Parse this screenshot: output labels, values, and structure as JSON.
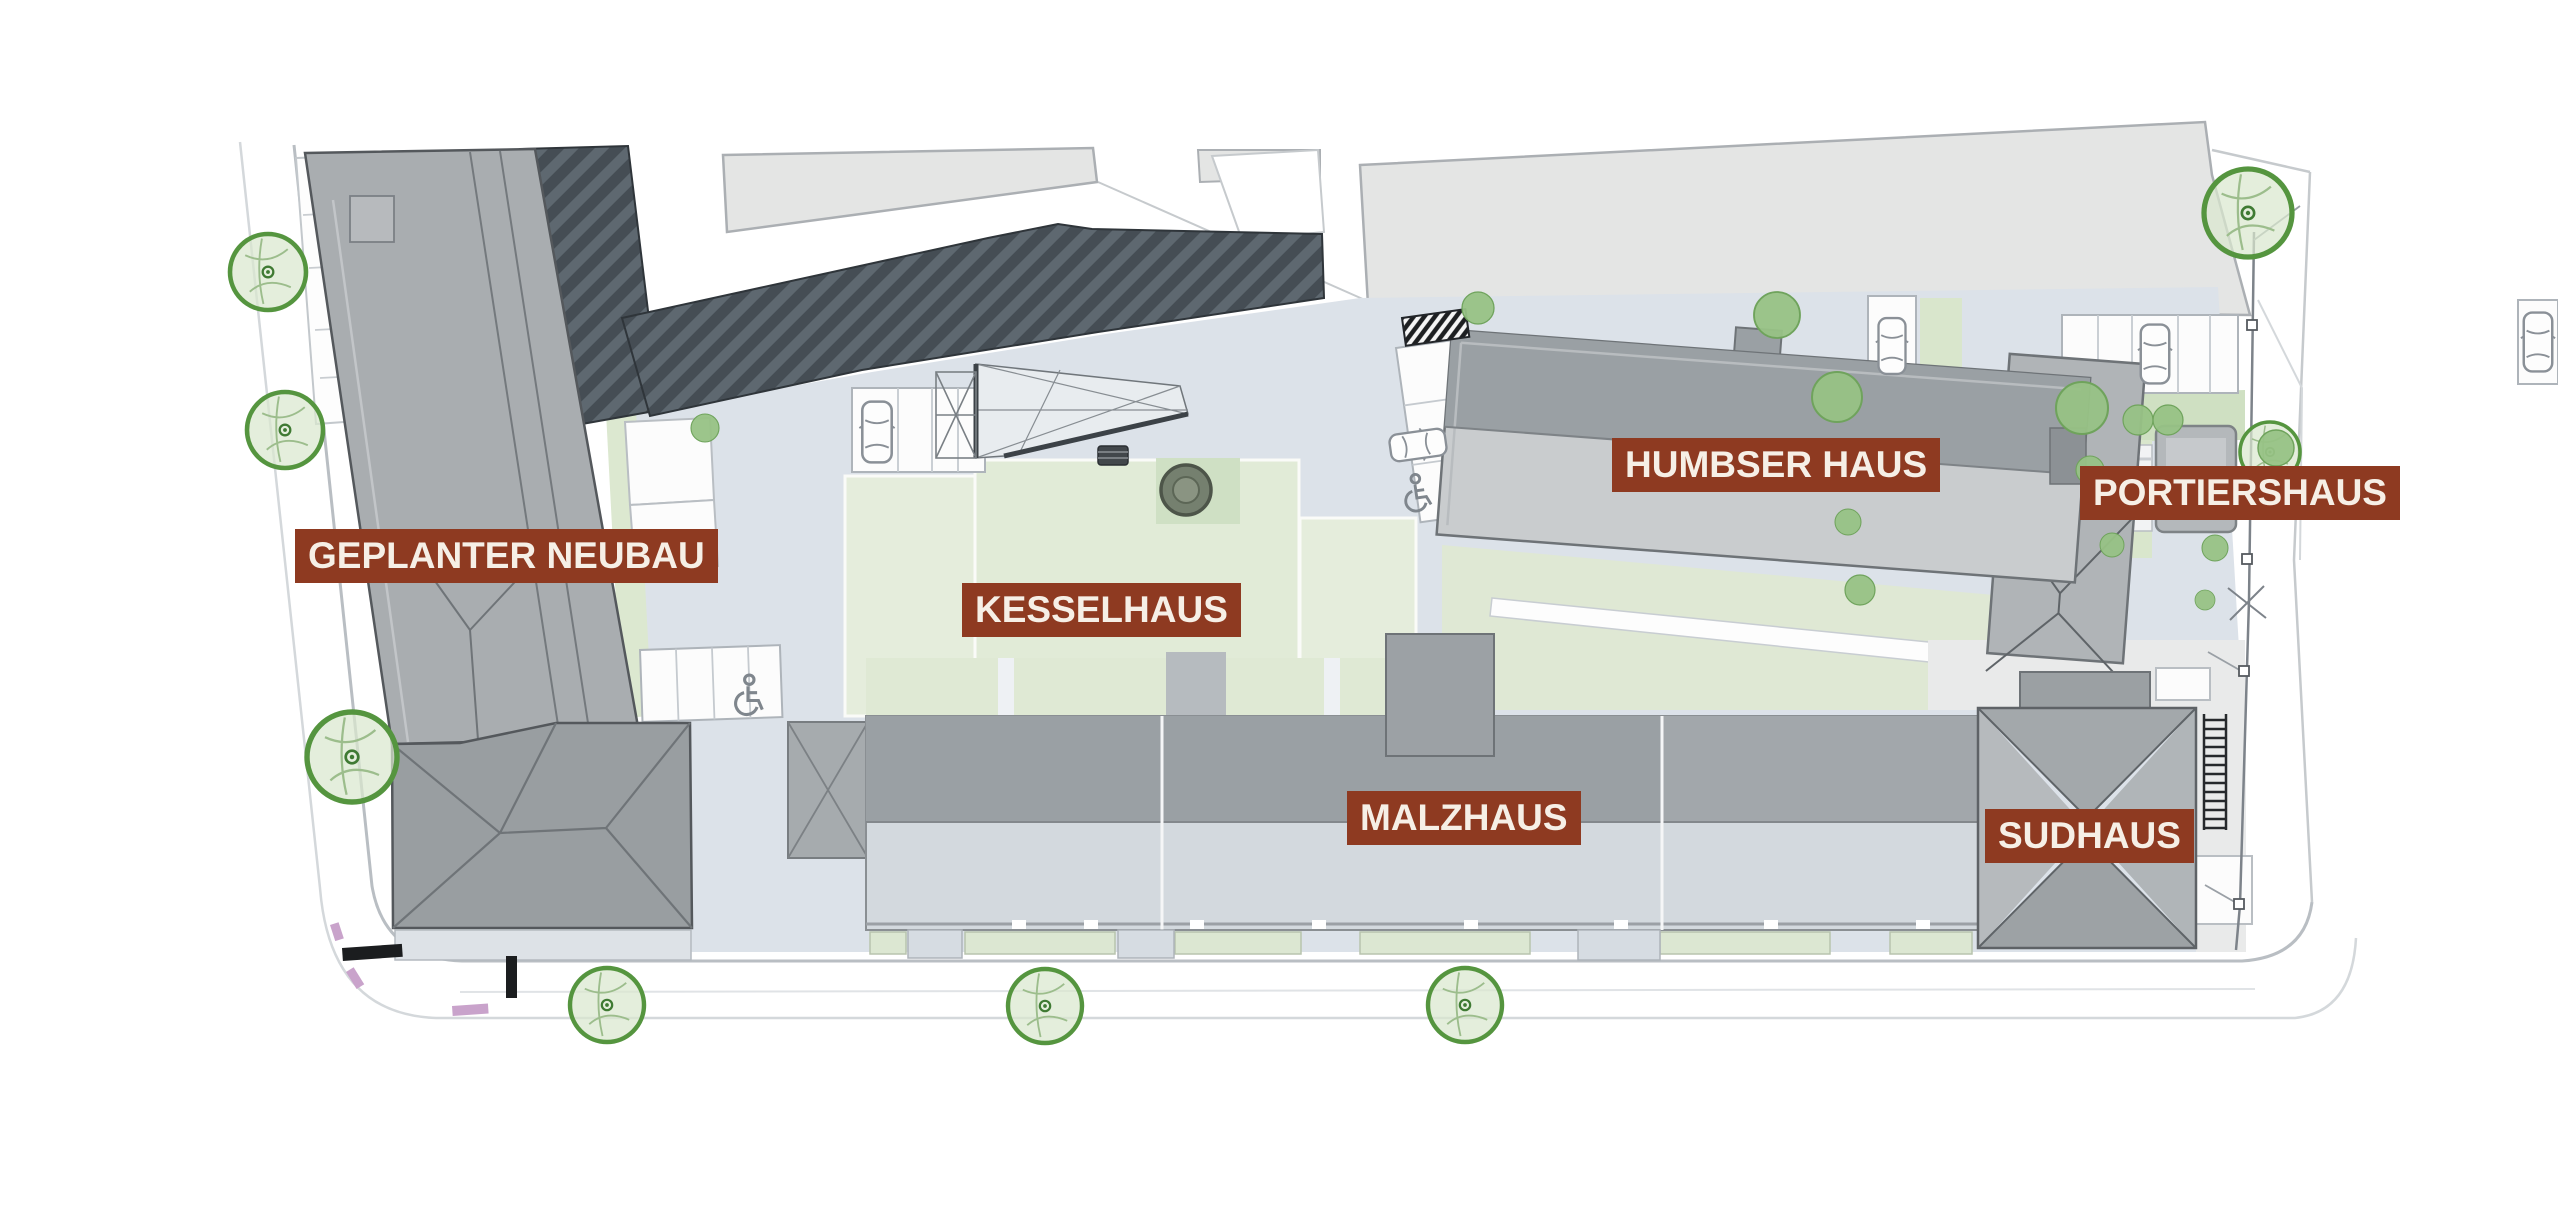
{
  "plan": {
    "type": "architectural-site-plan",
    "building_names": [
      "GEPLANTER NEUBAU",
      "KESSELHAUS",
      "HUMBSER HAUS",
      "PORTIERSHAUS",
      "MALZHAUS",
      "SUDHAUS"
    ]
  },
  "labels": [
    {
      "id": "geplanter-neubau",
      "text": "GEPLANTER NEUBAU"
    },
    {
      "id": "kesselhaus",
      "text": "KESSELHAUS"
    },
    {
      "id": "humbser-haus",
      "text": "HUMBSER HAUS"
    },
    {
      "id": "portiershaus",
      "text": "PORTIERSHAUS"
    },
    {
      "id": "malzhaus",
      "text": "MALZHAUS"
    },
    {
      "id": "sudhaus",
      "text": "SUDHAUS"
    }
  ],
  "palette": {
    "label_bg": "#8E3A21",
    "label_text": "#F6EFE6",
    "courtyard": "#DCE2E9",
    "lawn_light": "#E5EDDC",
    "lawn_mid": "#DFE9D4",
    "lawn_dark": "#CFE0C2",
    "building_gray": "#A9ADB0",
    "roof_dark_band": "#9AA0A4",
    "roof_light_band": "#C9CCCE",
    "hatch_roof_base": "#454D54",
    "hatch_roof_stripe": "#5E6870",
    "neighbor_building": "#E4E5E4",
    "tree_ring": "#55953F",
    "tree_fill": "#D9E8CE",
    "tree_solid": "#97C285",
    "street_line": "#B9BEC3",
    "fence": "#7D838A",
    "marking_pink": "#C9A3CB",
    "marking_black": "#1B1D1F"
  },
  "symbols": {
    "tree-icon": "green ring circle",
    "small-tree-icon": "solid green circle",
    "car-icon": "white rounded rectangle outline",
    "wheelchair-icon": "accessible parking glyph",
    "stairs-icon": "ladder rungs",
    "tank-icon": "dark ringed circle",
    "grate-icon": "black diagonal stripes",
    "fence-icon": "line with square posts"
  }
}
